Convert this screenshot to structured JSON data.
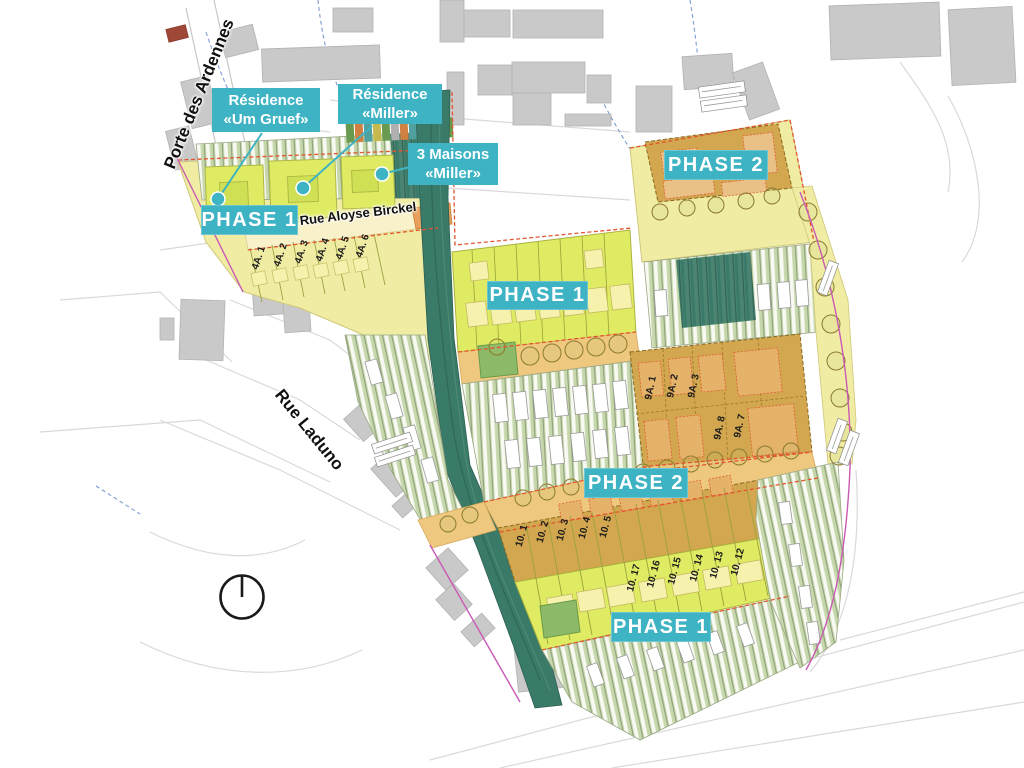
{
  "title": "Phased residential development site plan",
  "colors": {
    "accent_teal": "#3eb3c4",
    "zone_yellow": "#f1eca3",
    "lot_green": "#dfec63",
    "building_pale_yellow": "#f6f2ad",
    "garden_green": "#c6d8ab",
    "corridor_teal": "#3a7a68",
    "road_sand": "#eec87f",
    "block_tan": "#d2a74f",
    "existing_building_gray": "#c9c9c9",
    "boundary_red": "#e2552e",
    "boundary_pink": "#c959b5"
  },
  "streets": {
    "porte_des_ardennes": "Porte des Ardennes",
    "rue_aloyse_birckel": "Rue Aloyse Birckel",
    "rue_laduno": "Rue Laduno"
  },
  "callouts": {
    "um_gruef": {
      "line1": "Résidence",
      "line2": "«Um Gruef»"
    },
    "miller": {
      "line1": "Résidence",
      "line2": "«Miller»"
    },
    "maisons_miller": {
      "line1": "3 Maisons",
      "line2": "«Miller»"
    }
  },
  "phases": {
    "nw": "PHASE 1",
    "center": "PHASE 1",
    "ne": "PHASE 2",
    "mid": "PHASE 2",
    "south": "PHASE 1"
  },
  "lots": {
    "a4": [
      "4A. 1",
      "4A. 2",
      "4A. 3",
      "4A. 4",
      "4A. 5",
      "4A. 6"
    ],
    "a9": [
      "9A. 1",
      "9A. 2",
      "9A. 3",
      "9A. 8",
      "9A. 7"
    ],
    "t10_upper": [
      "10. 1",
      "10. 2",
      "10. 3",
      "10. 4",
      "10. 5"
    ],
    "t10_lower": [
      "10. 17",
      "10. 16",
      "10. 15",
      "10. 14",
      "10. 13",
      "10. 12"
    ]
  }
}
